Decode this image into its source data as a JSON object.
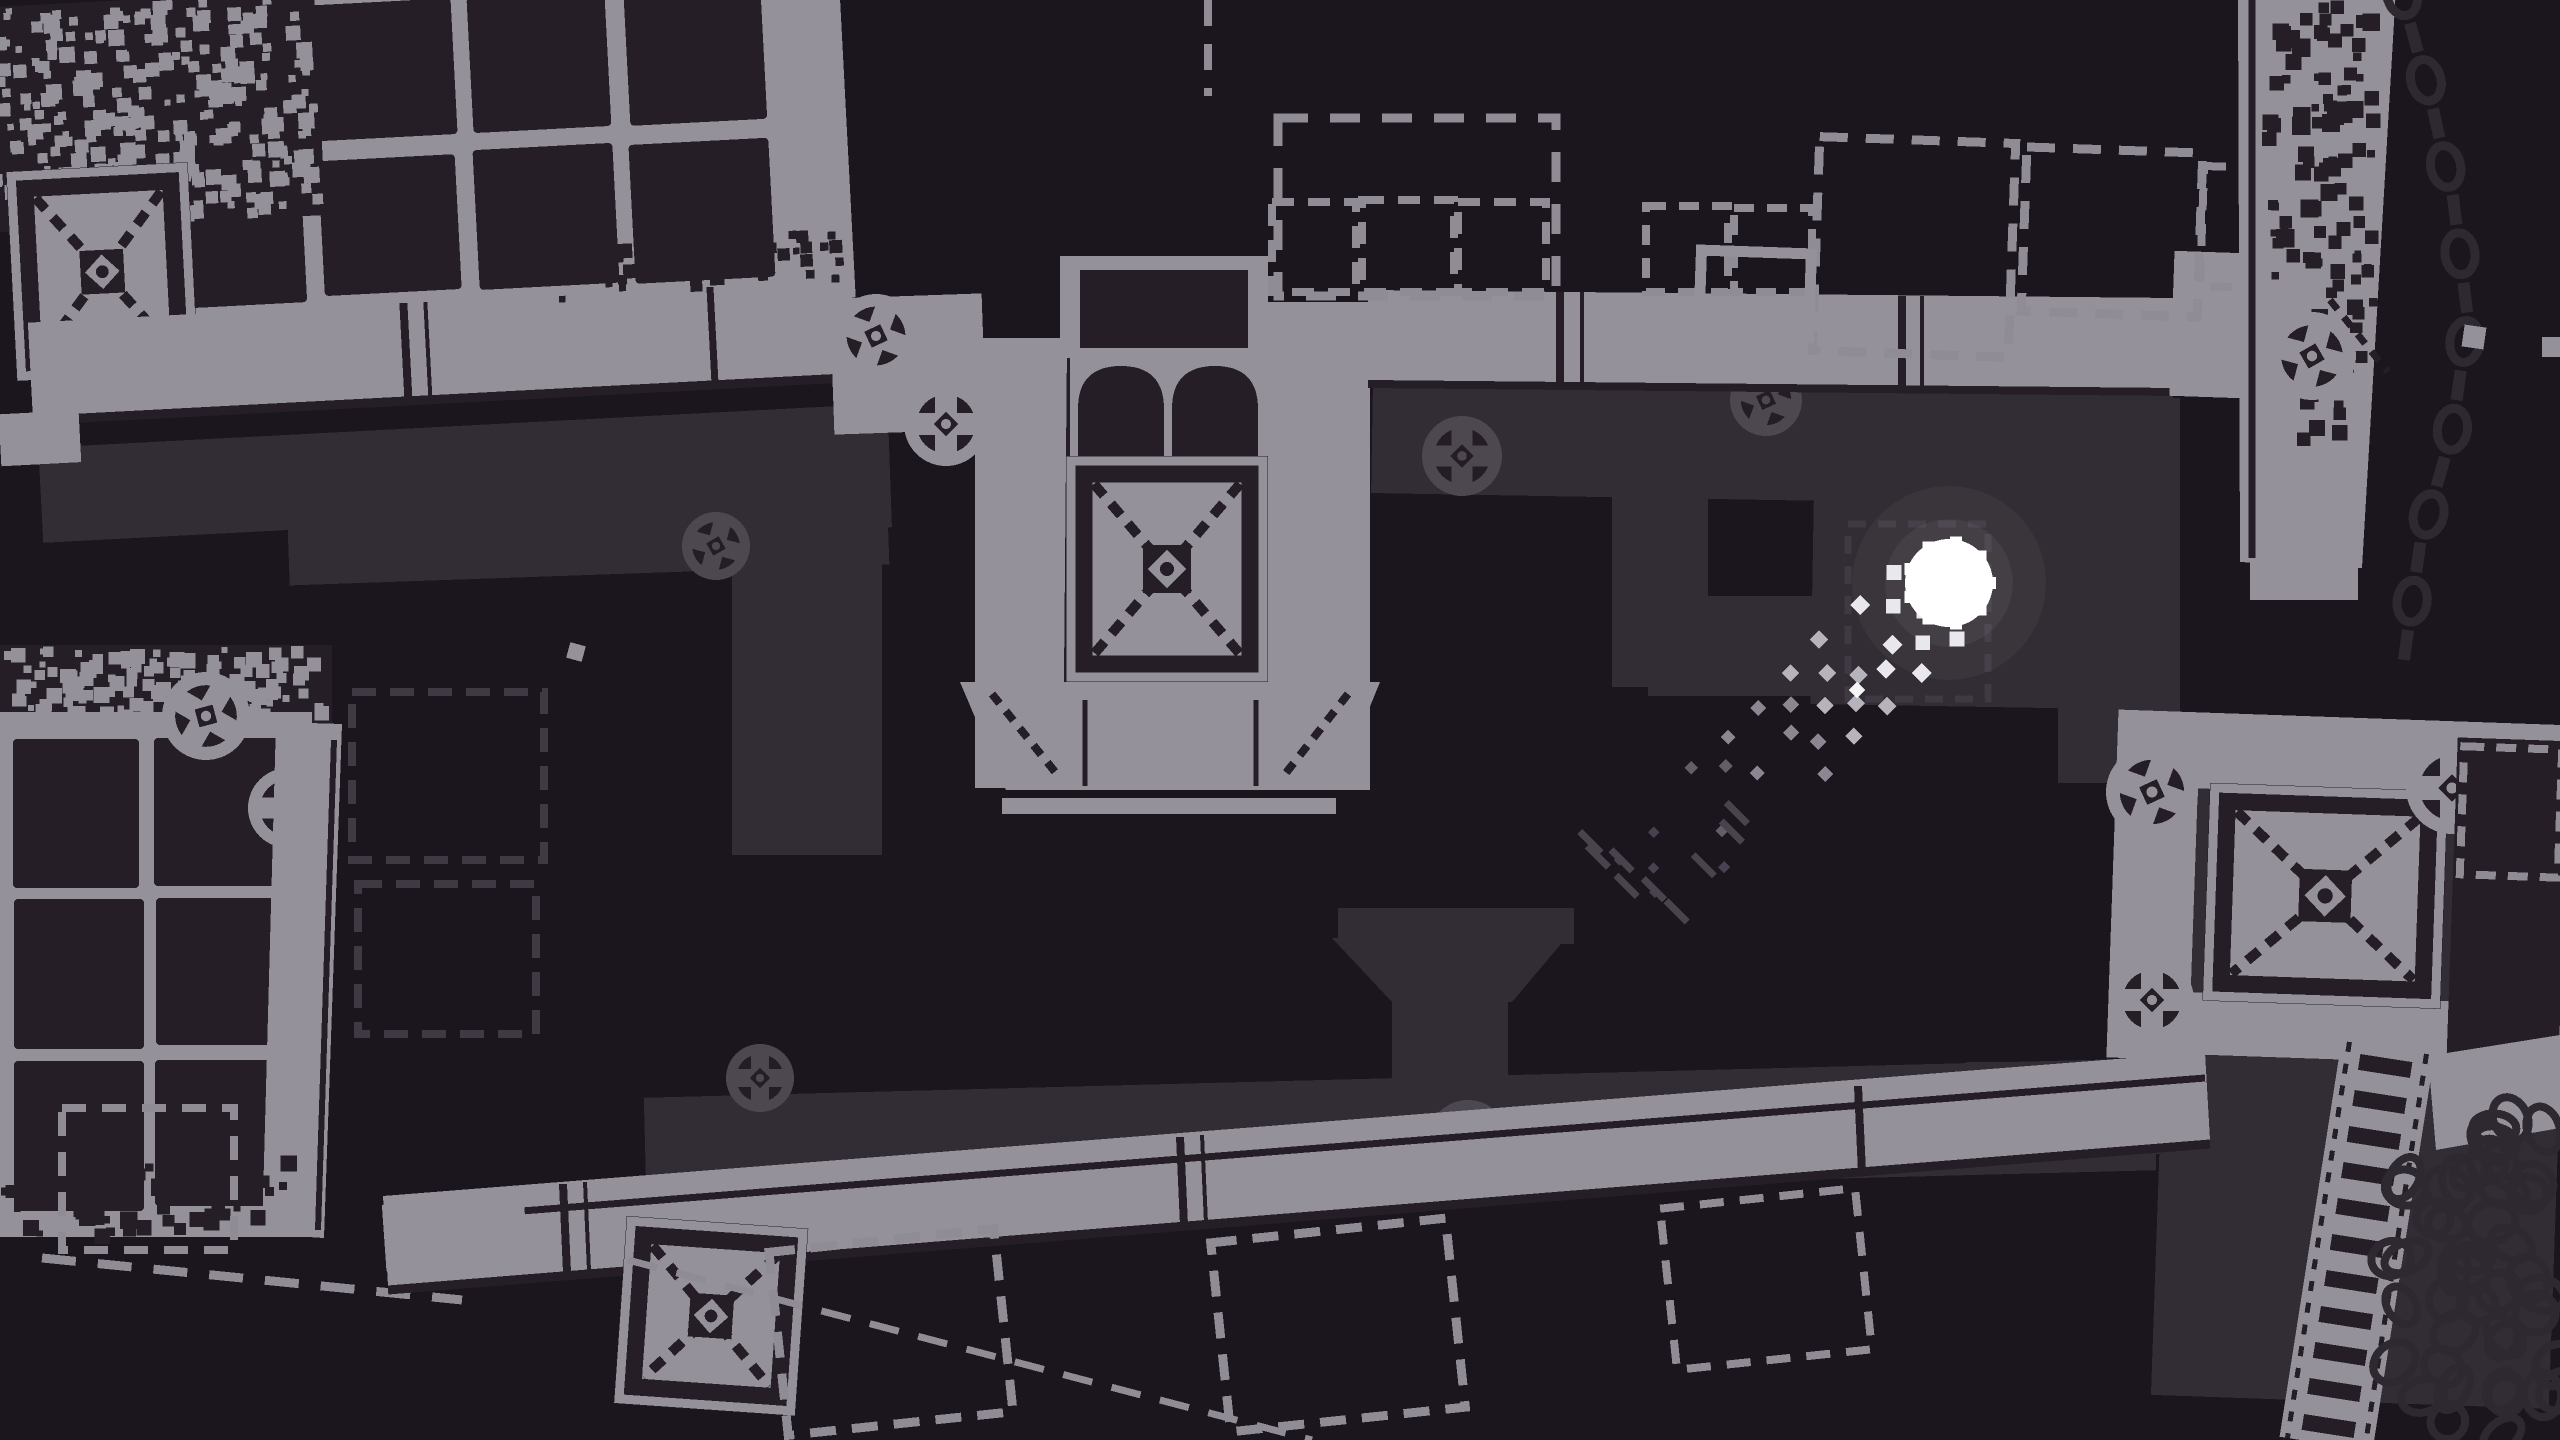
{
  "meta": {
    "label": "monochrome pixel-art game scene"
  },
  "palette": {
    "bg": "#1B151D",
    "light": "#94919A",
    "dark": "#251E26",
    "shadow": "#322C34",
    "shadowline": "#3F3944",
    "shadowring": "#4D4750",
    "shadowdark": "#241D25",
    "dashgray": "#8F8C95",
    "chain": "#2E2831",
    "white": "#FFFFFF"
  },
  "ball": {
    "x": 1949,
    "y": 583,
    "r": 44,
    "color": "#FFFFFF"
  },
  "trail": {
    "dx": -0.72,
    "dy": 0.69,
    "start": 38,
    "length": 400,
    "step": 23,
    "half_width": 2,
    "dot": 15,
    "tiers": [
      "#E8E7EC",
      "#B6B3BC",
      "#8B8792",
      "#625D68",
      "#474150"
    ],
    "streak_color": "#49434E",
    "streaks": 9,
    "seed": 9,
    "bright_speck": {
      "x": 1857,
      "y": 690
    }
  },
  "elements": [
    {
      "t": "rect",
      "x": 40,
      "y": 428,
      "w": 805,
      "h": 95,
      "f": "shadow",
      "rot": -3,
      "cx": 420,
      "cy": 470
    },
    {
      "t": "rect",
      "x": 560,
      "y": 418,
      "w": 330,
      "h": 115,
      "f": "shadow",
      "rot": -2
    },
    {
      "t": "rect",
      "x": 288,
      "y": 487,
      "w": 600,
      "h": 88,
      "f": "shadow",
      "rot": -2
    },
    {
      "t": "rect",
      "x": 732,
      "y": 560,
      "w": 150,
      "h": 295,
      "f": "shadow"
    },
    {
      "t": "joint",
      "x": 716,
      "y": 546,
      "r": 34,
      "tone": "shadow",
      "rot": 15
    },
    {
      "t": "dashrect",
      "x": 352,
      "y": 692,
      "w": 192,
      "h": 168,
      "s": "shadowline",
      "sw": 8,
      "dash": "24 14"
    },
    {
      "t": "dashrect",
      "x": 358,
      "y": 884,
      "w": 178,
      "h": 150,
      "s": "shadowline",
      "sw": 8,
      "dash": "24 14"
    },
    {
      "t": "rect",
      "x": 1372,
      "y": 388,
      "w": 800,
      "h": 112,
      "f": "shadow",
      "rot": 1
    },
    {
      "t": "joint",
      "x": 1462,
      "y": 456,
      "r": 40,
      "tone": "shadow",
      "rot": 0
    },
    {
      "t": "joint",
      "x": 1766,
      "y": 400,
      "r": 36,
      "tone": "shadow",
      "rot": 20
    },
    {
      "t": "rect",
      "x": 1612,
      "y": 472,
      "w": 96,
      "h": 215,
      "f": "shadow"
    },
    {
      "t": "rect",
      "x": 1648,
      "y": 596,
      "w": 178,
      "h": 100,
      "f": "shadow"
    },
    {
      "t": "rect",
      "x": 1812,
      "y": 502,
      "w": 358,
      "h": 205,
      "f": "shadow",
      "rot": 1
    },
    {
      "t": "rect",
      "x": 2058,
      "y": 398,
      "w": 122,
      "h": 385,
      "f": "shadow"
    },
    {
      "t": "dashrect",
      "x": 1848,
      "y": 524,
      "w": 140,
      "h": 175,
      "s": "shadowline",
      "sw": 7,
      "dash": "18 12"
    },
    {
      "t": "rect",
      "x": 1966,
      "y": 1062,
      "w": 205,
      "h": 92,
      "f": "shadow"
    },
    {
      "t": "rect",
      "x": 2162,
      "y": 762,
      "w": 398,
      "h": 640,
      "f": "shadow",
      "rot": 2
    },
    {
      "t": "rect",
      "x": 645,
      "y": 1078,
      "w": 1510,
      "h": 112,
      "f": "shadow",
      "rot": -1.5
    },
    {
      "t": "poly",
      "pts": [
        [
          1332,
          938
        ],
        [
          1566,
          938
        ],
        [
          1512,
          1002
        ],
        [
          1392,
          1002
        ]
      ],
      "f": "shadow"
    },
    {
      "t": "rect",
      "x": 1392,
      "y": 998,
      "w": 116,
      "h": 106,
      "f": "shadow"
    },
    {
      "t": "rect",
      "x": 1338,
      "y": 908,
      "w": 236,
      "h": 36,
      "f": "shadow"
    },
    {
      "t": "joint",
      "x": 760,
      "y": 1078,
      "r": 34,
      "tone": "shadow",
      "rot": 0
    },
    {
      "t": "joint",
      "x": 1468,
      "y": 1140,
      "r": 40,
      "tone": "shadow",
      "rot": 25
    },
    {
      "t": "rect",
      "x": 145,
      "y": -15,
      "w": 705,
      "h": 335,
      "f": "light",
      "rot": -3,
      "cx": 420,
      "cy": 200
    },
    {
      "t": "tiles",
      "x": 165,
      "y": 0,
      "cols": 4,
      "rows": 2,
      "tw": 140,
      "th": 138,
      "gx": 16,
      "gy": 16,
      "f": "dark",
      "seed": 7,
      "rot": -3,
      "cx": 420,
      "cy": 200
    },
    {
      "t": "rect",
      "x": -10,
      "y": -15,
      "w": 335,
      "h": 225,
      "f": "dark",
      "rot": -3,
      "cx": 420,
      "cy": 200
    },
    {
      "t": "noise",
      "x": -10,
      "y": -15,
      "w": 335,
      "h": 225,
      "f": "light",
      "cell": 13,
      "n": 300,
      "seed": 3,
      "rot": -3,
      "cx": 420,
      "cy": 200
    },
    {
      "t": "xblock",
      "x": 8,
      "y": 150,
      "w": 182,
      "h": 210,
      "rot": -3,
      "cx": 420,
      "cy": 200
    },
    {
      "t": "rect",
      "x": 22,
      "y": 302,
      "w": 825,
      "h": 96,
      "f": "light",
      "rot": -3,
      "cx": 420,
      "cy": 200
    },
    {
      "t": "line",
      "x1": 398,
      "y1": 302,
      "x2": 398,
      "y2": 398,
      "s": "dark",
      "sw": 8,
      "rot": -3,
      "cx": 420,
      "cy": 200
    },
    {
      "t": "line",
      "x1": 420,
      "y1": 302,
      "x2": 420,
      "y2": 398,
      "s": "dark",
      "sw": 4,
      "rot": -3,
      "cx": 420,
      "cy": 200
    },
    {
      "t": "line",
      "x1": 705,
      "y1": 302,
      "x2": 705,
      "y2": 398,
      "s": "dark",
      "sw": 7,
      "rot": -3,
      "cx": 420,
      "cy": 200
    },
    {
      "t": "line",
      "x1": 22,
      "y1": 400,
      "x2": 847,
      "y2": 400,
      "s": "dark",
      "sw": 9,
      "rot": -3,
      "cx": 420,
      "cy": 200
    },
    {
      "t": "rect",
      "x": -12,
      "y": 392,
      "w": 80,
      "h": 52,
      "f": "light",
      "rot": -3,
      "cx": 420,
      "cy": 200
    },
    {
      "t": "noise",
      "x": 520,
      "y": 250,
      "w": 320,
      "h": 60,
      "f": "dark",
      "cell": 12,
      "n": 60,
      "seed": 8,
      "rot": -3,
      "cx": 420,
      "cy": 200
    },
    {
      "t": "rect",
      "x": 832,
      "y": 296,
      "w": 152,
      "h": 136,
      "f": "light",
      "rot": -2
    },
    {
      "t": "joint",
      "x": 876,
      "y": 336,
      "r": 42,
      "tone": "light",
      "rot": 20
    },
    {
      "t": "joint",
      "x": 946,
      "y": 424,
      "r": 42,
      "tone": "light",
      "rot": 0
    },
    {
      "t": "rect",
      "x": 975,
      "y": 338,
      "w": 102,
      "h": 450,
      "f": "light"
    },
    {
      "t": "line",
      "x1": 1070,
      "y1": 346,
      "x2": 1066,
      "y2": 786,
      "s": "dark",
      "sw": 6
    },
    {
      "t": "rect",
      "x": 1252,
      "y": 302,
      "w": 118,
      "h": 488,
      "f": "light"
    },
    {
      "t": "line",
      "x1": 1258,
      "y1": 310,
      "x2": 1258,
      "y2": 786,
      "s": "dark",
      "sw": 5
    },
    {
      "t": "rect",
      "x": 1060,
      "y": 256,
      "w": 208,
      "h": 102,
      "f": "light"
    },
    {
      "t": "rect",
      "x": 1080,
      "y": 270,
      "w": 168,
      "h": 78,
      "f": "dark"
    },
    {
      "t": "arch2",
      "x": 1070,
      "y": 352,
      "w": 198,
      "h": 110
    },
    {
      "t": "xblock",
      "x": 1066,
      "y": 456,
      "w": 202,
      "h": 226
    },
    {
      "t": "poly",
      "pts": [
        [
          960,
          682
        ],
        [
          1380,
          682
        ],
        [
          1336,
          790
        ],
        [
          1006,
          790
        ]
      ],
      "f": "light"
    },
    {
      "t": "line",
      "x1": 992,
      "y1": 694,
      "x2": 1060,
      "y2": 778,
      "s": "dark",
      "sw": 8,
      "dash": "12 10"
    },
    {
      "t": "line",
      "x1": 1348,
      "y1": 694,
      "x2": 1282,
      "y2": 778,
      "s": "dark",
      "sw": 8,
      "dash": "12 10"
    },
    {
      "t": "line",
      "x1": 1085,
      "y1": 700,
      "x2": 1085,
      "y2": 786,
      "s": "dark",
      "sw": 5
    },
    {
      "t": "line",
      "x1": 1256,
      "y1": 700,
      "x2": 1256,
      "y2": 786,
      "s": "dark",
      "sw": 5
    },
    {
      "t": "rect",
      "x": 1002,
      "y": 798,
      "w": 334,
      "h": 16,
      "f": "light"
    },
    {
      "t": "line",
      "x1": 1286,
      "y1": 462,
      "x2": 1320,
      "y2": 462,
      "s": "light",
      "sw": 5
    },
    {
      "t": "poly",
      "pts": [
        [
          1368,
          290
        ],
        [
          2175,
          298
        ],
        [
          2175,
          388
        ],
        [
          1368,
          380
        ]
      ],
      "f": "light"
    },
    {
      "t": "line",
      "x1": 1368,
      "y1": 384,
      "x2": 2175,
      "y2": 392,
      "s": "dark",
      "sw": 8
    },
    {
      "t": "line",
      "x1": 1560,
      "y1": 292,
      "x2": 1560,
      "y2": 384,
      "s": "dark",
      "sw": 8
    },
    {
      "t": "line",
      "x1": 1582,
      "y1": 292,
      "x2": 1582,
      "y2": 384,
      "s": "dark",
      "sw": 4
    },
    {
      "t": "line",
      "x1": 1902,
      "y1": 296,
      "x2": 1902,
      "y2": 388,
      "s": "dark",
      "sw": 8
    },
    {
      "t": "line",
      "x1": 1922,
      "y1": 296,
      "x2": 1922,
      "y2": 388,
      "s": "dark",
      "sw": 4
    },
    {
      "t": "rect",
      "x": 2172,
      "y": 252,
      "w": 70,
      "h": 145,
      "f": "light",
      "rot": 2
    },
    {
      "t": "dashrect",
      "x": 1278,
      "y": 118,
      "w": 278,
      "h": 178,
      "s": "dashgray",
      "sw": 9,
      "dash": "30 22"
    },
    {
      "t": "dashrect",
      "x": 1272,
      "y": 202,
      "w": 84,
      "h": 90,
      "s": "dashgray",
      "sw": 8,
      "dash": "22 14"
    },
    {
      "t": "dashrect",
      "x": 1362,
      "y": 200,
      "w": 92,
      "h": 92,
      "s": "dashgray",
      "sw": 8,
      "dash": "22 14"
    },
    {
      "t": "dashrect",
      "x": 1458,
      "y": 202,
      "w": 88,
      "h": 90,
      "s": "dashgray",
      "sw": 8,
      "dash": "22 14"
    },
    {
      "t": "dashrect",
      "x": 1646,
      "y": 206,
      "w": 82,
      "h": 86,
      "s": "dashgray",
      "sw": 8,
      "dash": "20 13"
    },
    {
      "t": "dashrect",
      "x": 1734,
      "y": 208,
      "w": 78,
      "h": 84,
      "s": "dashgray",
      "sw": 8,
      "dash": "20 13"
    },
    {
      "t": "line",
      "x1": 1208,
      "y1": 0,
      "x2": 1208,
      "y2": 96,
      "s": "dashgray",
      "sw": 8,
      "dash": "26 18"
    },
    {
      "t": "dashrect",
      "x": 1816,
      "y": 140,
      "w": 196,
      "h": 214,
      "s": "dashgray",
      "sw": 9,
      "dash": "28 18",
      "rot": 2
    },
    {
      "t": "dashrect",
      "x": 2024,
      "y": 150,
      "w": 176,
      "h": 164,
      "s": "dashgray",
      "sw": 9,
      "dash": "28 18",
      "rot": 2
    },
    {
      "t": "dashrect",
      "x": 2202,
      "y": 168,
      "w": 118,
      "h": 120,
      "s": "dashgray",
      "sw": 8,
      "dash": "22 14",
      "rot": 2
    },
    {
      "t": "dashrect",
      "x": 1700,
      "y": 252,
      "w": 110,
      "h": 84,
      "s": "light",
      "sw": 11,
      "dash": "999 1",
      "rot": 2
    },
    {
      "t": "poly",
      "pts": [
        [
          2238,
          -12
        ],
        [
          2396,
          -12
        ],
        [
          2362,
          568
        ],
        [
          2240,
          562
        ]
      ],
      "f": "light"
    },
    {
      "t": "line",
      "x1": 2252,
      "y1": -8,
      "x2": 2252,
      "y2": 558,
      "s": "dark",
      "sw": 7
    },
    {
      "t": "noise",
      "x": 2262,
      "y": 0,
      "w": 120,
      "h": 280,
      "f": "dark",
      "cell": 15,
      "n": 80,
      "seed": 11
    },
    {
      "t": "noise",
      "x": 2295,
      "y": 250,
      "w": 85,
      "h": 210,
      "f": "dark",
      "cell": 13,
      "n": 40,
      "seed": 12
    },
    {
      "t": "joint",
      "x": 2312,
      "y": 356,
      "r": 44,
      "tone": "light",
      "rot": 15
    },
    {
      "t": "line",
      "x1": 2330,
      "y1": 300,
      "x2": 2388,
      "y2": 372,
      "s": "dark",
      "sw": 7,
      "dash": "12 10"
    },
    {
      "t": "rect",
      "x": 2250,
      "y": 560,
      "w": 108,
      "h": 40,
      "f": "light"
    },
    {
      "t": "chain",
      "pts": [
        [
          2402,
          -5
        ],
        [
          2430,
          95
        ],
        [
          2454,
          205
        ],
        [
          2468,
          320
        ],
        [
          2452,
          432
        ],
        [
          2420,
          545
        ],
        [
          2406,
          645
        ]
      ],
      "n": 16
    },
    {
      "t": "rect",
      "x": 0,
      "y": 645,
      "w": 332,
      "h": 85,
      "f": "dark"
    },
    {
      "t": "noise",
      "x": 0,
      "y": 645,
      "w": 332,
      "h": 85,
      "f": "light",
      "cell": 13,
      "n": 140,
      "seed": 21
    },
    {
      "t": "rect",
      "x": 0,
      "y": 712,
      "w": 312,
      "h": 525,
      "f": "light"
    },
    {
      "t": "tiles",
      "x": 12,
      "y": 738,
      "cols": 2,
      "rows": 3,
      "tw": 128,
      "th": 148,
      "gx": 16,
      "gy": 14,
      "f": "dark",
      "seed": 5
    },
    {
      "t": "joint",
      "x": 206,
      "y": 716,
      "r": 44,
      "tone": "light",
      "rot": 30
    },
    {
      "t": "joint",
      "x": 288,
      "y": 808,
      "r": 40,
      "tone": "light",
      "rot": 0
    },
    {
      "t": "poly",
      "pts": [
        [
          276,
          722
        ],
        [
          342,
          724
        ],
        [
          324,
          1238
        ],
        [
          262,
          1234
        ]
      ],
      "f": "light"
    },
    {
      "t": "line",
      "x1": 334,
      "y1": 740,
      "x2": 318,
      "y2": 1230,
      "s": "dark",
      "sw": 6
    },
    {
      "t": "noise",
      "x": 0,
      "y": 1150,
      "w": 300,
      "h": 95,
      "f": "dark",
      "cell": 14,
      "n": 70,
      "seed": 22
    },
    {
      "t": "dashrect",
      "x": 62,
      "y": 1108,
      "w": 172,
      "h": 142,
      "s": "dashgray",
      "sw": 8,
      "dash": "24 16"
    },
    {
      "t": "line",
      "x1": 42,
      "y1": 1258,
      "x2": 462,
      "y2": 1300,
      "s": "dashgray",
      "sw": 9,
      "dash": "34 22"
    },
    {
      "t": "poly",
      "pts": [
        [
          383,
          1196
        ],
        [
          2205,
          1052
        ],
        [
          2210,
          1140
        ],
        [
          388,
          1286
        ]
      ],
      "f": "light"
    },
    {
      "t": "line",
      "x1": 383,
      "y1": 1222,
      "x2": 2205,
      "y2": 1078,
      "s": "dark",
      "sw": 7
    },
    {
      "t": "line",
      "x1": 388,
      "y1": 1290,
      "x2": 2210,
      "y2": 1144,
      "s": "dark",
      "sw": 9
    },
    {
      "t": "line",
      "x1": 563,
      "y1": 1184,
      "x2": 567,
      "y2": 1272,
      "s": "dark",
      "sw": 8
    },
    {
      "t": "line",
      "x1": 585,
      "y1": 1182,
      "x2": 589,
      "y2": 1270,
      "s": "dark",
      "sw": 4
    },
    {
      "t": "line",
      "x1": 1180,
      "y1": 1137,
      "x2": 1184,
      "y2": 1225,
      "s": "dark",
      "sw": 8
    },
    {
      "t": "line",
      "x1": 1202,
      "y1": 1135,
      "x2": 1206,
      "y2": 1223,
      "s": "dark",
      "sw": 4
    },
    {
      "t": "line",
      "x1": 1858,
      "y1": 1086,
      "x2": 1862,
      "y2": 1172,
      "s": "dark",
      "sw": 8
    },
    {
      "t": "rect",
      "x": 384,
      "y": 1200,
      "w": 142,
      "h": 66,
      "f": "light",
      "rot": -4
    },
    {
      "t": "xblock",
      "x": 620,
      "y": 1222,
      "w": 182,
      "h": 188,
      "rot": 4
    },
    {
      "t": "dashrect",
      "x": 778,
      "y": 1240,
      "w": 226,
      "h": 184,
      "s": "dashgray",
      "sw": 9,
      "dash": "26 16",
      "rot": -6
    },
    {
      "t": "dashrect",
      "x": 1220,
      "y": 1230,
      "w": 236,
      "h": 190,
      "s": "dashgray",
      "sw": 9,
      "dash": "26 16",
      "rot": -6
    },
    {
      "t": "dashrect",
      "x": 1668,
      "y": 1198,
      "w": 196,
      "h": 162,
      "s": "dashgray",
      "sw": 8,
      "dash": "24 16",
      "rot": -6
    },
    {
      "t": "line",
      "x1": 628,
      "y1": 1260,
      "x2": 1312,
      "y2": 1440,
      "s": "dashgray",
      "sw": 7,
      "dash": "30 20"
    },
    {
      "t": "rect",
      "x": 2112,
      "y": 716,
      "w": 452,
      "h": 76,
      "f": "light",
      "rot": 2,
      "cx": 2300,
      "cy": 900
    },
    {
      "t": "rect",
      "x": 2112,
      "y": 716,
      "w": 82,
      "h": 348,
      "f": "light",
      "rot": 2,
      "cx": 2300,
      "cy": 900
    },
    {
      "t": "rect",
      "x": 2118,
      "y": 996,
      "w": 448,
      "h": 62,
      "f": "light",
      "rot": 2,
      "cx": 2300,
      "cy": 900
    },
    {
      "t": "xblock",
      "x": 2206,
      "y": 786,
      "w": 238,
      "h": 218,
      "rot": 2,
      "cx": 2300,
      "cy": 900
    },
    {
      "t": "joint",
      "x": 2152,
      "y": 792,
      "r": 46,
      "tone": "light",
      "rot": 20
    },
    {
      "t": "joint",
      "x": 2152,
      "y": 1000,
      "r": 42,
      "tone": "light",
      "rot": 0
    },
    {
      "t": "joint",
      "x": 2452,
      "y": 788,
      "r": 46,
      "tone": "light",
      "rot": 0
    },
    {
      "t": "rect",
      "x": 2452,
      "y": 732,
      "w": 112,
      "h": 330,
      "f": "dark",
      "rot": 2,
      "cx": 2300,
      "cy": 900
    },
    {
      "t": "dashrect",
      "x": 2462,
      "y": 748,
      "w": 98,
      "h": 128,
      "s": "dashgray",
      "sw": 8,
      "dash": "20 12",
      "rot": 2
    },
    {
      "t": "poly",
      "pts": [
        [
          2428,
          1056
        ],
        [
          2560,
          1035
        ],
        [
          2560,
          1128
        ],
        [
          2436,
          1150
        ]
      ],
      "f": "light"
    },
    {
      "t": "rail",
      "x1": 2388,
      "y1": 1048,
      "x2": 2326,
      "y2": 1444,
      "w": 94,
      "n": 11
    },
    {
      "t": "pile",
      "x": 2386,
      "y": 1168,
      "w": 178,
      "h": 272,
      "n": 36,
      "seed": 31
    },
    {
      "t": "pile",
      "x": 2468,
      "y": 1118,
      "w": 92,
      "h": 92,
      "n": 10,
      "seed": 32
    },
    {
      "t": "speck",
      "x": 576,
      "y": 652,
      "s": 16,
      "f": "light",
      "rot": 15
    },
    {
      "t": "speck",
      "x": 2474,
      "y": 337,
      "s": 22,
      "f": "light",
      "rot": 8
    },
    {
      "t": "speck",
      "x": 2552,
      "y": 347,
      "s": 20,
      "f": "light",
      "rot": 0
    }
  ]
}
